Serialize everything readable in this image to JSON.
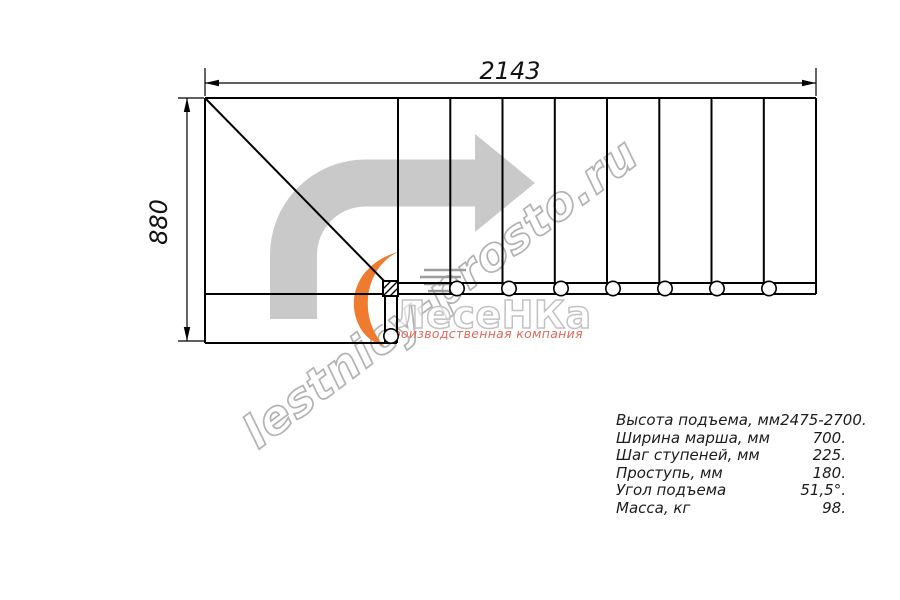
{
  "drawing": {
    "width_dimension": "2143",
    "height_dimension": "880"
  },
  "watermark": {
    "site": "lestnicy-prosto.ru"
  },
  "logo": {
    "name": "ЛесеНКа",
    "tagline": "Производственная компания"
  },
  "specs": {
    "rows": [
      {
        "label": "Высота подъема, мм",
        "value": "2475-2700."
      },
      {
        "label": "Ширина марша, мм",
        "value": "700."
      },
      {
        "label": "Шаг ступеней, мм",
        "value": "225."
      },
      {
        "label": "Проступь, мм",
        "value": "180."
      },
      {
        "label": "Угол подъема",
        "value": "51,5°."
      },
      {
        "label": "Масса, кг",
        "value": "98."
      }
    ]
  },
  "colors": {
    "line_black": "#000000",
    "arrow_gray": "#c9c9c9",
    "watermark_gray": "#b2b2b2",
    "logo_orange": "#ee7b30",
    "logo_red": "#e0685c",
    "text_dark": "#1b1b1b"
  }
}
